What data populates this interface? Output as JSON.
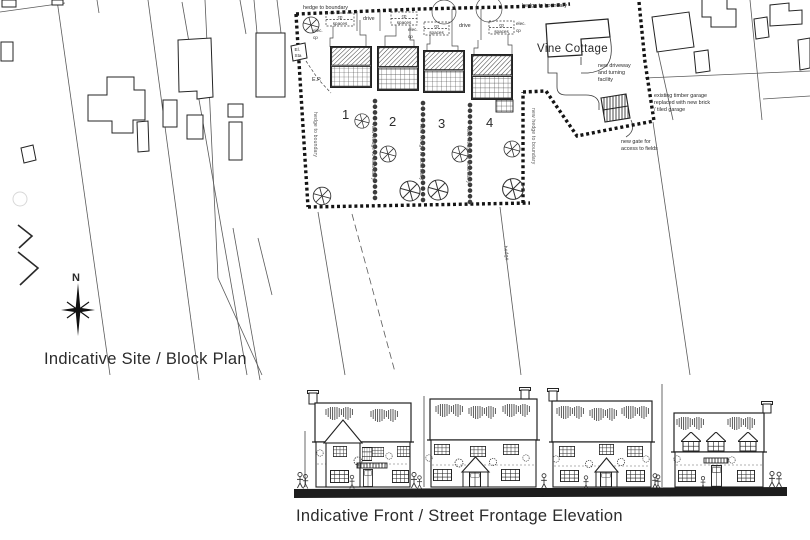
{
  "colors": {
    "paper": "#ffffff",
    "ink": "#2b2b2b"
  },
  "site_plan": {
    "caption": "Indicative Site / Block Plan",
    "north_label": "N",
    "plot_numbers": [
      "1",
      "2",
      "3",
      "4"
    ],
    "vine_cottage_label": "Vine Cottage",
    "boundary": {
      "hedge_top_left": "hedge to boundary",
      "hedge_top_right": "hedge to boundary",
      "hedge_left": "hedge to boundary",
      "new_hedge": "new hedge to boundary",
      "hedge_field": "hedge"
    },
    "parking": {
      "cp": "cp",
      "spaces": "spaces"
    },
    "drive_label": "drive",
    "electrical": {
      "elec": "elec.",
      "cp": "cp",
      "el_sta_line1": "El.",
      "el_sta_line2": "Sta",
      "ep": "E.P."
    },
    "notes": {
      "driveway": [
        "new driveway",
        "and turning",
        "facility"
      ],
      "gate": [
        "new gate for",
        "access to fields"
      ],
      "garage": [
        "existing timber garage",
        "replaced with new brick",
        "/ tiled garage"
      ]
    }
  },
  "elevation": {
    "caption": "Indicative Front / Street Frontage Elevation"
  }
}
